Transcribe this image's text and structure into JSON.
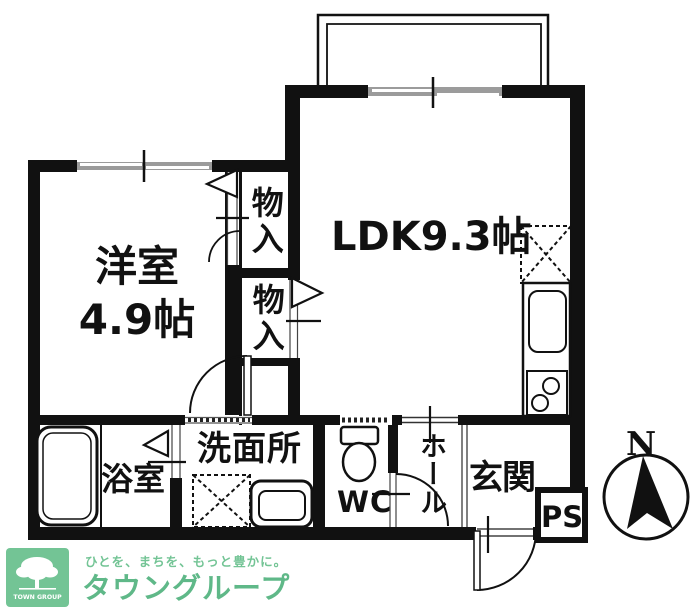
{
  "rooms": {
    "ldk": {
      "label": "LDK9.3帖"
    },
    "western": {
      "line1": "洋室",
      "line2": "4.9帖"
    },
    "closet_upper": {
      "label": "物入"
    },
    "closet_lower": {
      "label": "物入"
    },
    "bath": {
      "label": "浴室"
    },
    "washroom": {
      "label": "洗面所"
    },
    "wc": {
      "label": "WC"
    },
    "hall": {
      "label": "ホール"
    },
    "entrance": {
      "label": "玄関"
    },
    "pipe_space": {
      "label": "PS"
    }
  },
  "compass": {
    "north": "N"
  },
  "footer": {
    "logo_box_text": "TOWN GROUP",
    "tagline": "ひとを、まちを、もっと豊かに。",
    "brand": "タウングループ"
  },
  "colors": {
    "wall": "#111111",
    "window_gray": "#9b9b9b",
    "logo_green": "#73c495",
    "brand_green": "#5fb888"
  }
}
